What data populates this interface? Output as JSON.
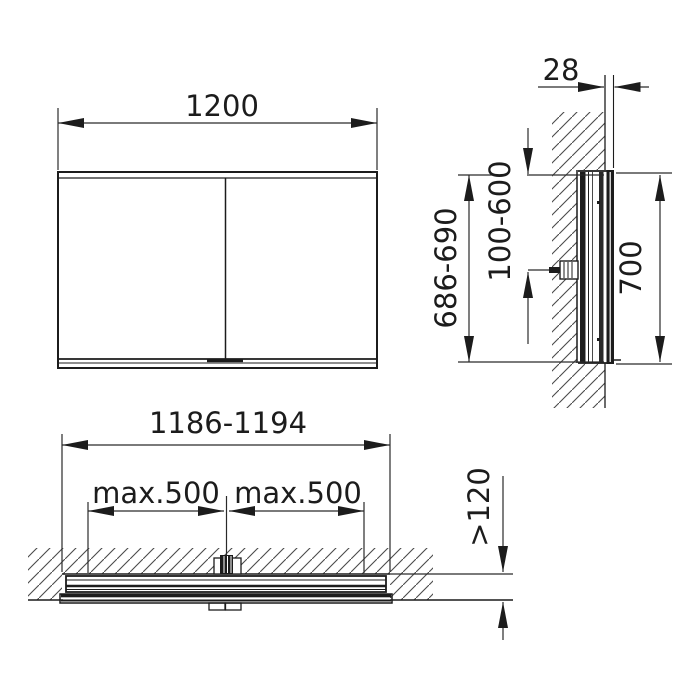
{
  "drawing": {
    "type": "technical-dimension-drawing",
    "subject": "double-door mirror cabinet, recessed wall installation",
    "colors": {
      "background": "#ffffff",
      "line": "#1c1c1c",
      "hatch": "#4a4a4a"
    },
    "views": {
      "front": {
        "name": "front view",
        "width_label": "1200"
      },
      "side": {
        "name": "side section view",
        "depth_label": "28",
        "niche_height_label": "686-690",
        "connection_height_label": "100-600",
        "door_height_label": "700"
      },
      "plan": {
        "name": "top section view",
        "niche_width_label": "1186-1194",
        "max_left_label": "max.500",
        "max_right_label": "max.500",
        "niche_depth_label": ">120"
      }
    }
  }
}
